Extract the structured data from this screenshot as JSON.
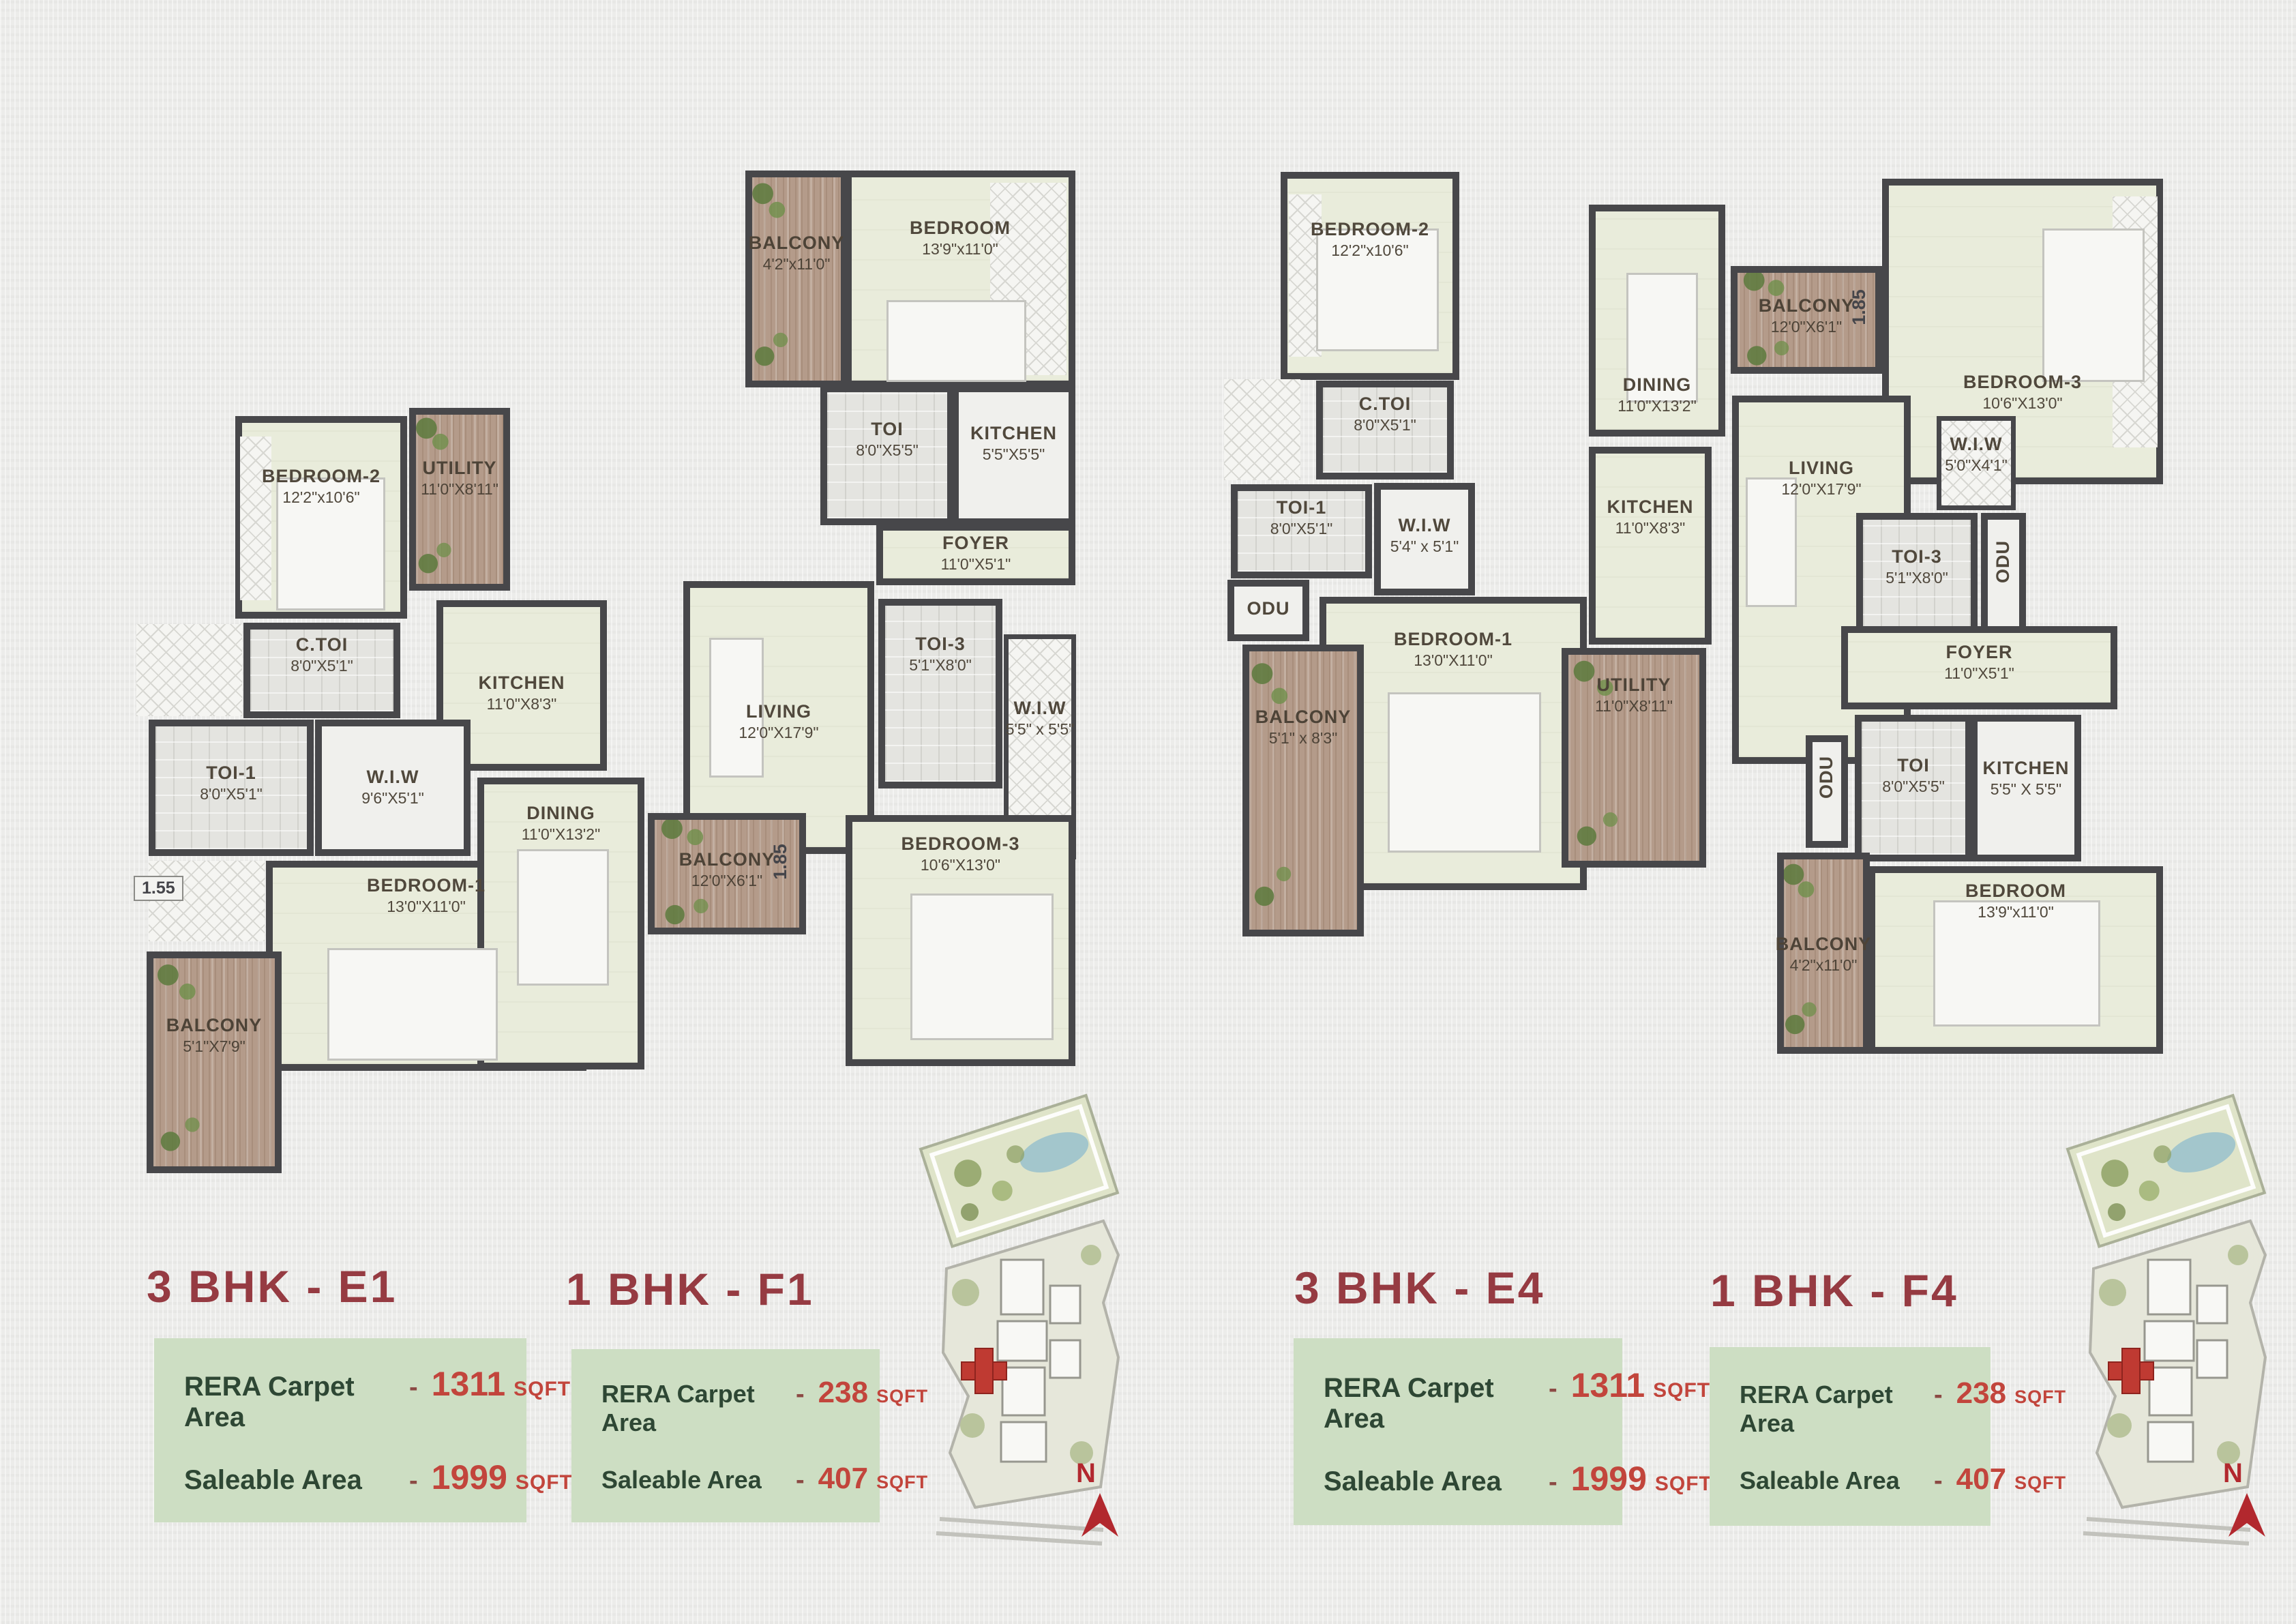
{
  "area_boxes": [
    {
      "title": "3 BHK - E1",
      "rows": [
        {
          "label": "RERA Carpet Area",
          "dash": "-",
          "value": "1311",
          "unit": "SQFT"
        },
        {
          "label": "Saleable Area",
          "dash": "-",
          "value": "1999",
          "unit": "SQFT"
        }
      ]
    },
    {
      "title": "1 BHK - F1",
      "rows": [
        {
          "label": "RERA Carpet Area",
          "dash": "-",
          "value": "238",
          "unit": "SQFT"
        },
        {
          "label": "Saleable Area",
          "dash": "-",
          "value": "407",
          "unit": "SQFT"
        }
      ]
    },
    {
      "title": "3 BHK - E4",
      "rows": [
        {
          "label": "RERA Carpet Area",
          "dash": "-",
          "value": "1311",
          "unit": "SQFT"
        },
        {
          "label": "Saleable Area",
          "dash": "-",
          "value": "1999",
          "unit": "SQFT"
        }
      ]
    },
    {
      "title": "1 BHK - F4",
      "rows": [
        {
          "label": "RERA Carpet Area",
          "dash": "-",
          "value": "238",
          "unit": "SQFT"
        },
        {
          "label": "Saleable Area",
          "dash": "-",
          "value": "407",
          "unit": "SQFT"
        }
      ]
    }
  ],
  "floorplans": {
    "left_rooms": [
      {
        "label": "BALCONY",
        "dims": "4'2\"x11'0\""
      },
      {
        "label": "BEDROOM",
        "dims": "13'9\"x11'0\""
      },
      {
        "label": "TOI",
        "dims": "8'0\"X5'5\""
      },
      {
        "label": "KITCHEN",
        "dims": "5'5\"X5'5\""
      },
      {
        "label": "FOYER",
        "dims": "11'0\"X5'1\""
      },
      {
        "label": "BEDROOM-2",
        "dims": "12'2\"x10'6\""
      },
      {
        "label": "UTILITY",
        "dims": "11'0\"X8'11\""
      },
      {
        "label": "C.TOI",
        "dims": "8'0\"X5'1\""
      },
      {
        "label": "KITCHEN",
        "dims": "11'0\"X8'3\""
      },
      {
        "label": "LIVING",
        "dims": "12'0\"X17'9\""
      },
      {
        "label": "TOI-3",
        "dims": "5'1\"X8'0\""
      },
      {
        "label": "W.I.W",
        "dims": "5'5\" x 5'5\""
      },
      {
        "label": "TOI-1",
        "dims": "8'0\"X5'1\""
      },
      {
        "label": "W.I.W",
        "dims": "9'6\"X5'1\""
      },
      {
        "label": "BEDROOM-1",
        "dims": "13'0\"X11'0\""
      },
      {
        "label": "DINING",
        "dims": "11'0\"X13'2\""
      },
      {
        "label": "BALCONY",
        "dims": "12'0\"X6'1\""
      },
      {
        "label": "BEDROOM-3",
        "dims": "10'6\"X13'0\""
      },
      {
        "label": "BALCONY",
        "dims": "5'1\"X7'9\""
      }
    ],
    "left_markers": {
      "m155": "1.55",
      "m185": "1.85"
    },
    "right_rooms": [
      {
        "label": "BEDROOM-2",
        "dims": "12'2\"x10'6\""
      },
      {
        "label": "DINING",
        "dims": "11'0\"X13'2\""
      },
      {
        "label": "BALCONY",
        "dims": "12'0\"X6'1\""
      },
      {
        "label": "BEDROOM-3",
        "dims": "10'6\"X13'0\""
      },
      {
        "label": "C.TOI",
        "dims": "8'0\"X5'1\""
      },
      {
        "label": "TOI-1",
        "dims": "8'0\"X5'1\""
      },
      {
        "label": "W.I.W",
        "dims": "5'4\" x 5'1\""
      },
      {
        "label": "KITCHEN",
        "dims": "11'0\"X8'3\""
      },
      {
        "label": "LIVING",
        "dims": "12'0\"X17'9\""
      },
      {
        "label": "W.I.W",
        "dims": "5'0\"X4'1\""
      },
      {
        "label": "TOI-3",
        "dims": "5'1\"X8'0\""
      },
      {
        "label": "ODU",
        "dims": ""
      },
      {
        "label": "BEDROOM-1",
        "dims": "13'0\"X11'0\""
      },
      {
        "label": "BALCONY",
        "dims": "5'1\" x 8'3\""
      },
      {
        "label": "ODU",
        "dims": ""
      },
      {
        "label": "UTILITY",
        "dims": "11'0\"X8'11\""
      },
      {
        "label": "FOYER",
        "dims": "11'0\"X5'1\""
      },
      {
        "label": "ODU",
        "dims": ""
      },
      {
        "label": "TOI",
        "dims": "8'0\"X5'5\""
      },
      {
        "label": "KITCHEN",
        "dims": "5'5\" X 5'5\""
      },
      {
        "label": "BEDROOM",
        "dims": "13'9\"x11'0\""
      },
      {
        "label": "BALCONY",
        "dims": "4'2\"x11'0\""
      }
    ],
    "right_markers": {
      "m185": "1.85"
    }
  },
  "site_map": {
    "north_label": "N"
  },
  "colors": {
    "accent_red": "#c2453c",
    "heading_maroon": "#963b42",
    "label_green": "#2e4734",
    "box_green": "#cddec3",
    "wall": "#47474a",
    "balcony_wood": "#b49b8a"
  }
}
